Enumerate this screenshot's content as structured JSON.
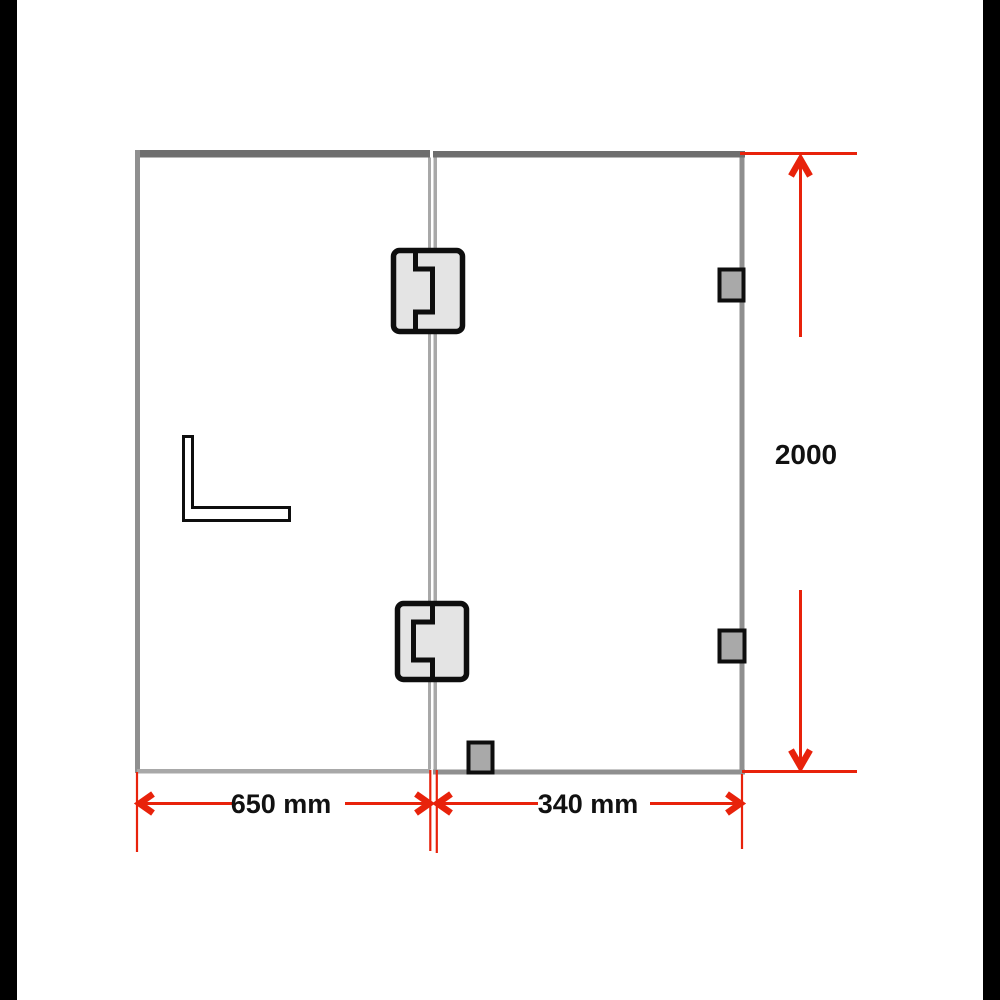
{
  "labels": {
    "panel_left_width": "650 mm",
    "panel_right_width": "340 mm",
    "overall_height": "2000"
  },
  "colors": {
    "background": "#ffffff",
    "letterbox": "#000000",
    "dimension-red": "#e8220b",
    "frame-dark": "#6e6e6e",
    "frame-mid": "#8f8f8f",
    "frame-light": "#a8a8a8",
    "hardware-ink": "#0e0e0e",
    "hinge-fill": "#e4e4e4",
    "clip-fill": "#a9a9a9",
    "label-ink": "#111111"
  },
  "components": [
    "left-glass-panel",
    "door-glass-panel",
    "glass-hinge-top",
    "glass-hinge-bottom",
    "wall-clip-top",
    "wall-clip-bottom",
    "floor-clip",
    "l-bracket"
  ]
}
